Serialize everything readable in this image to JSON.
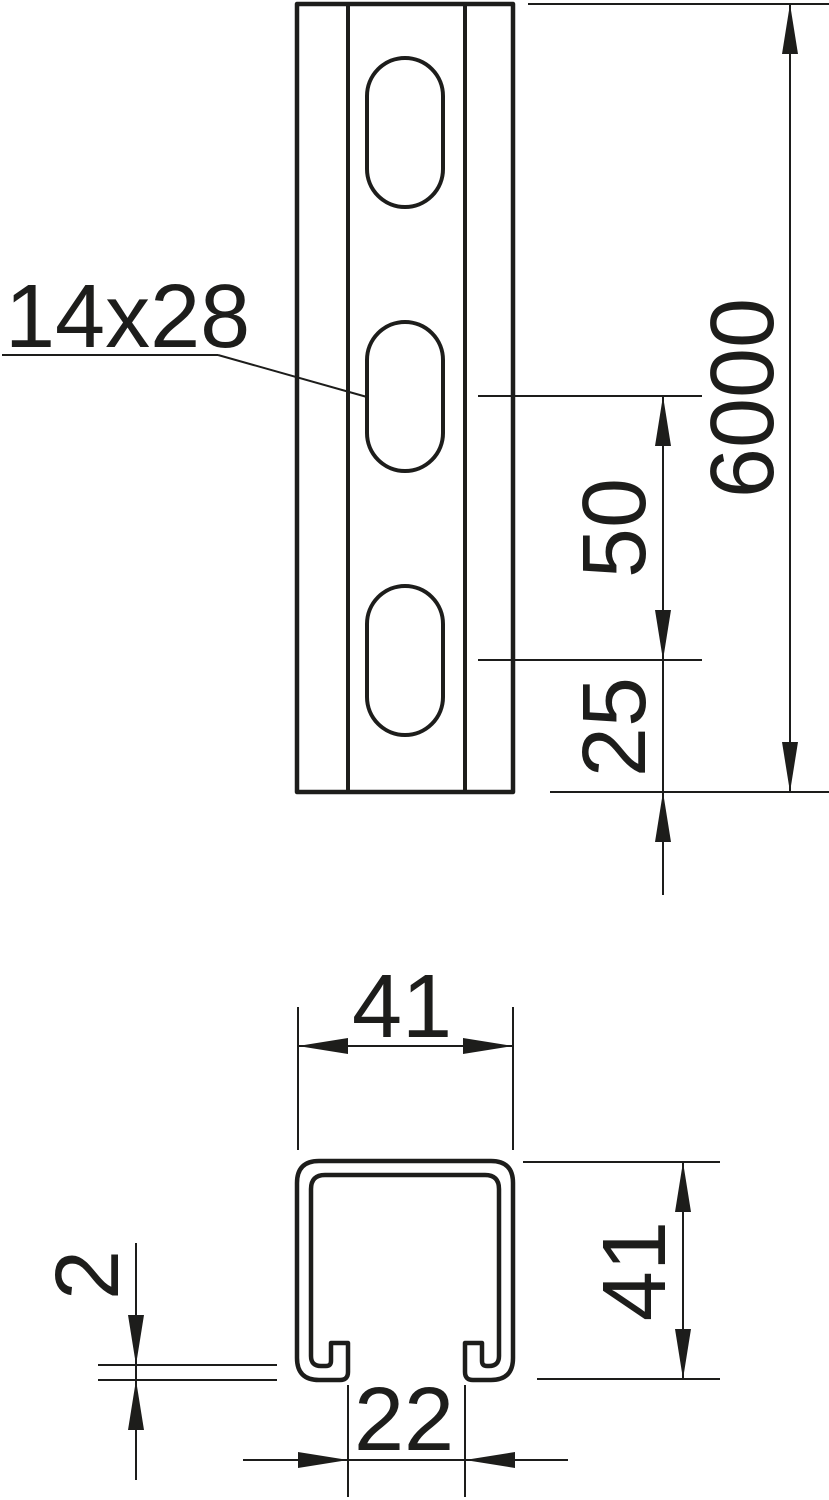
{
  "colors": {
    "ink": "#1d1d1b",
    "background": "#ffffff"
  },
  "drawing": {
    "front_view": {
      "slot_size": "14x28",
      "profile_length": "6000",
      "slot_pitch": "50",
      "slot_end_offset": "25"
    },
    "cross_section": {
      "width": "41",
      "height": "41",
      "material_thickness": "2",
      "slot_opening_width": "22"
    }
  }
}
